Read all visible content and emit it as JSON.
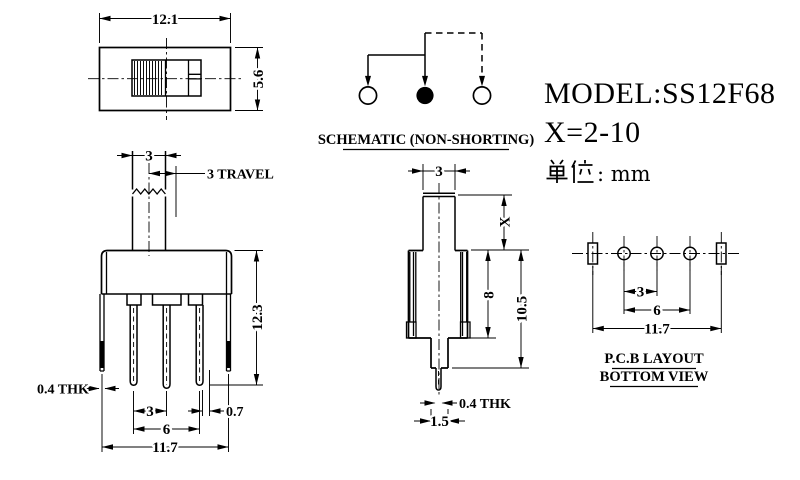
{
  "drawing": {
    "top_view": {
      "width": "12.1",
      "height": "5.6"
    },
    "front_view": {
      "knob_width": "3",
      "travel_label": "3 TRAVEL",
      "total_height": "12.3",
      "tab_thk": "0.4 THK",
      "pin_pitch": "3",
      "pin_span": "6",
      "bottom_span": "11.7",
      "edge_offset": "0.7"
    },
    "schematic": {
      "caption": "SCHEMATIC (NON-SHORTING)"
    },
    "side_view": {
      "knob_width": "3",
      "knob_height": "X",
      "body_height": "8",
      "overall_height": "10.5",
      "pin_thk": "0.4 THK",
      "pin_width": "1.5"
    },
    "pcb_layout": {
      "pitch": "3",
      "span": "6",
      "slot_span": "11.7",
      "caption_line1": "P.C.B LAYOUT",
      "caption_line2": "BOTTOM VIEW"
    },
    "info": {
      "model": "MODEL:SS12F68",
      "x_range": "X=2-10",
      "unit_label_cjk": "单位",
      "unit_suffix": ": mm"
    }
  }
}
